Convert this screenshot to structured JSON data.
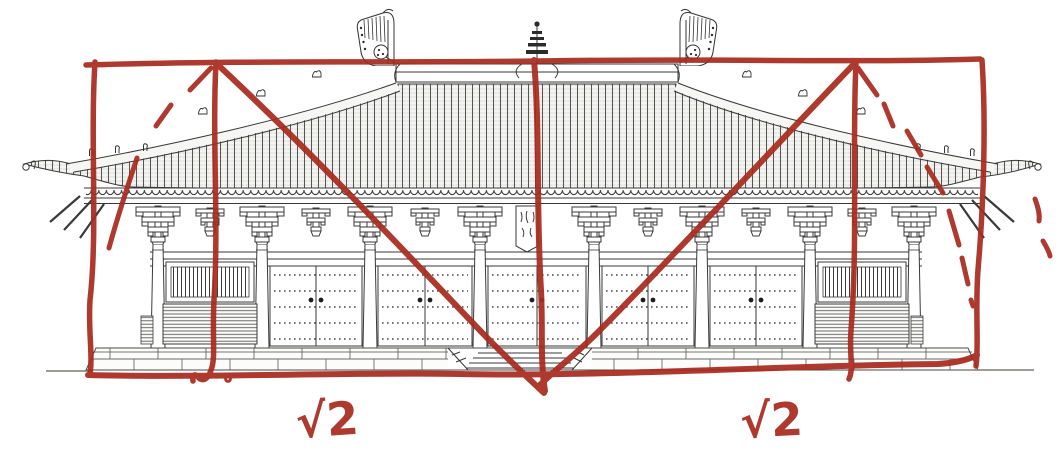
{
  "figure": {
    "background_color": "#ffffff",
    "ink_color": "#383838",
    "annotation": {
      "color": "#a82b1f",
      "labels": {
        "left": "√2",
        "right": "√2"
      }
    }
  }
}
